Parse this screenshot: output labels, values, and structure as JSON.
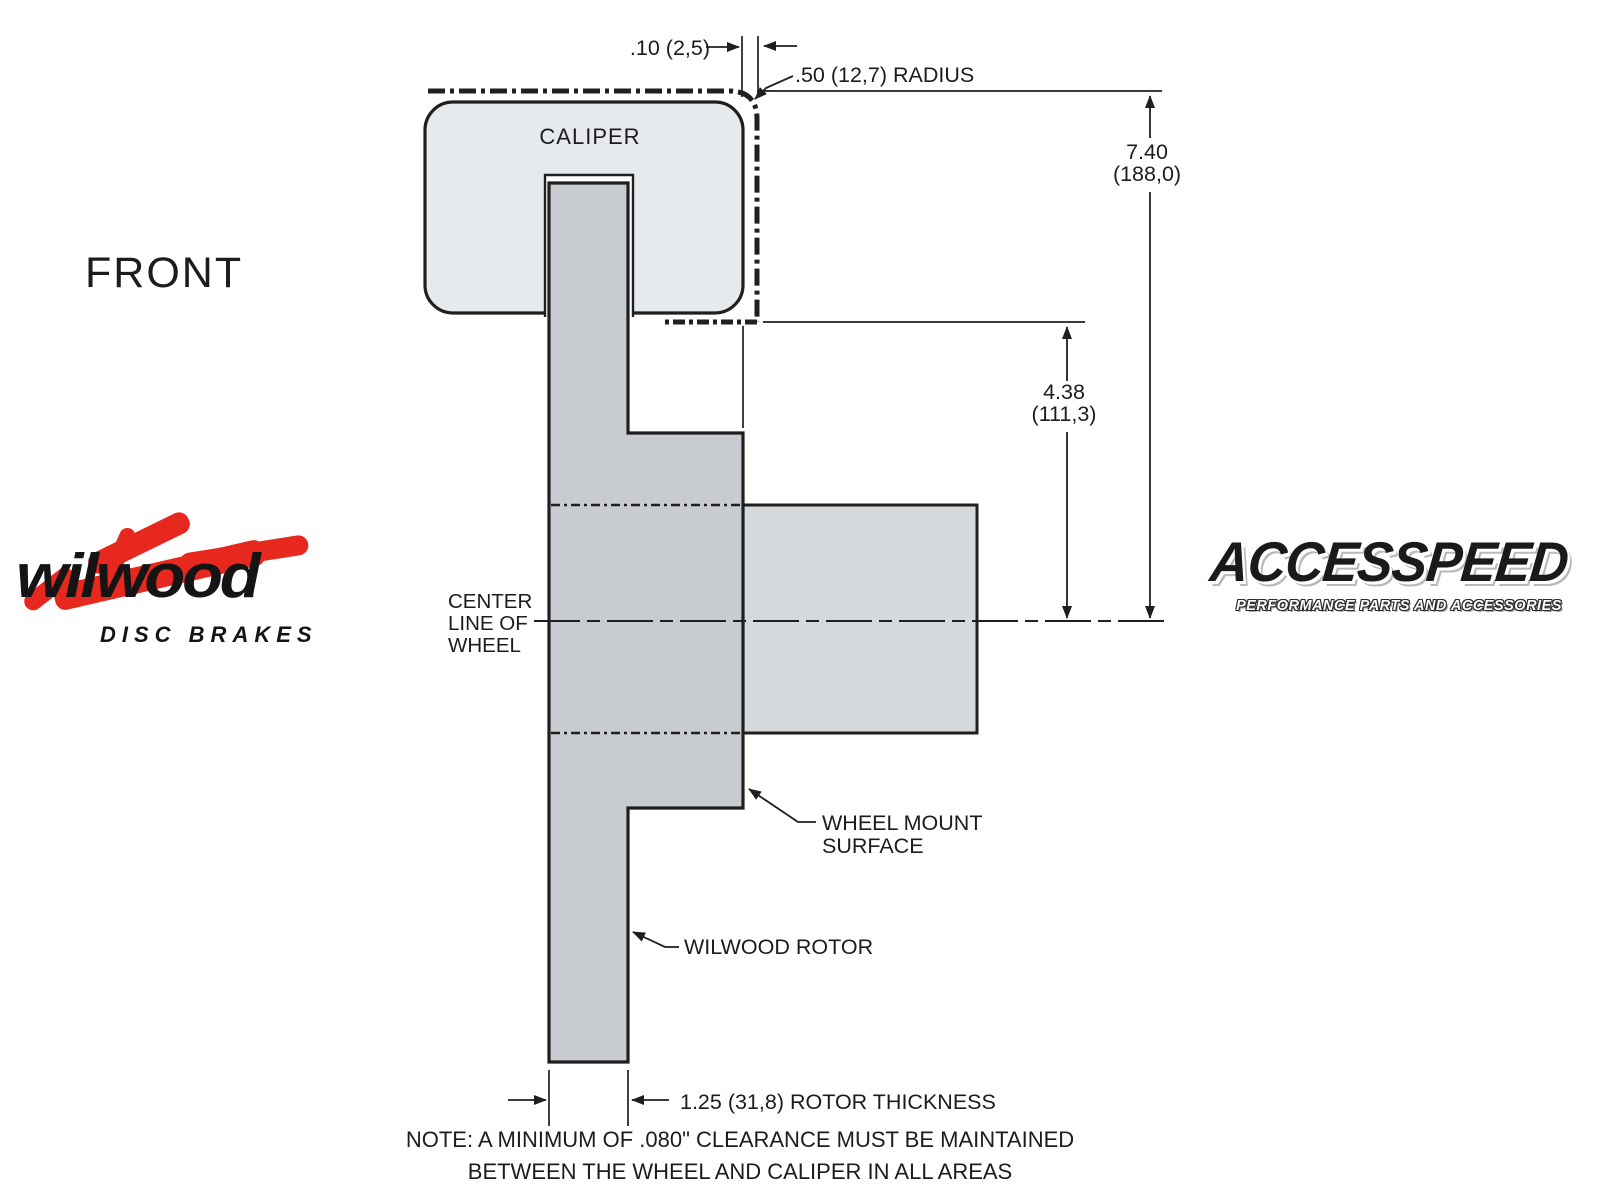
{
  "page": {
    "background": "#ffffff"
  },
  "drawing": {
    "view_label": "FRONT",
    "caliper_label": "CALIPER",
    "centerline_label": {
      "line1": "CENTER",
      "line2": "LINE OF",
      "line3": "WHEEL"
    },
    "dims": {
      "clearance": ".10 (2,5)",
      "radius": ".50 (12,7) RADIUS",
      "wheel_radius_in": "7.40",
      "wheel_radius_mm": "(188,0)",
      "caliper_radius_in": "4.38",
      "caliper_radius_mm": "(111,3)",
      "rotor_thickness": "1.25 (31,8) ROTOR THICKNESS"
    },
    "callouts": {
      "wheel_mount_line1": "WHEEL MOUNT",
      "wheel_mount_line2": "SURFACE",
      "wilwood_rotor": "WILWOOD ROTOR"
    },
    "note": {
      "line1": "NOTE: A MINIMUM OF .080\" CLEARANCE MUST BE MAINTAINED",
      "line2": "BETWEEN THE WHEEL AND CALIPER IN ALL AREAS"
    },
    "colors": {
      "line": "#1f1f1f",
      "caliper_fill": "#e7eaed",
      "rotor_fill": "#c8ccd0",
      "hub_fill": "#d5d9dc"
    }
  },
  "logos": {
    "wilwood": {
      "wordmark": "wilwood",
      "tagline": "DISC BRAKES",
      "red": "#e6281e"
    },
    "accesspeed": {
      "wordmark": "ACCESSPEED",
      "tagline": "PERFORMANCE PARTS AND ACCESSORIES"
    }
  }
}
